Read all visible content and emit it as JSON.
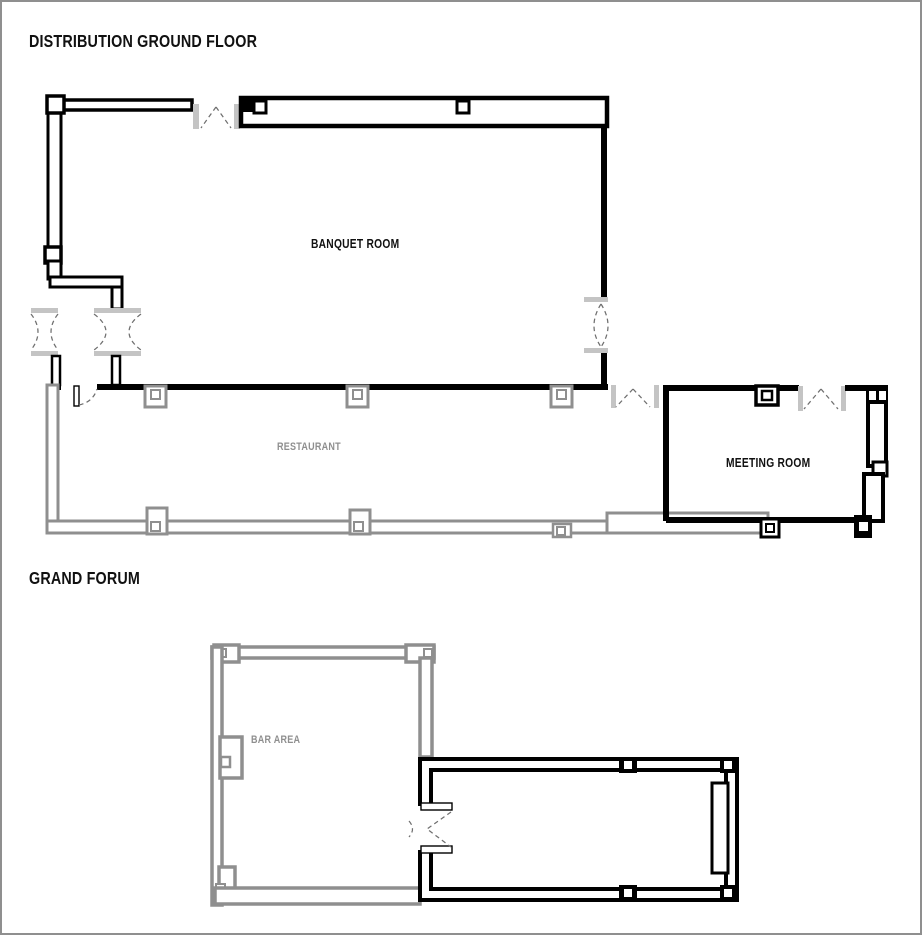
{
  "page": {
    "width": 922,
    "height": 935,
    "background": "#ffffff"
  },
  "colors": {
    "wall_primary": "#000000",
    "wall_secondary": "#8f8f8f",
    "door_jamb": "#c4c4c4",
    "door_swing_dash": "#6f6f6f",
    "label_primary": "#111111",
    "label_muted": "#8f8f8f",
    "page_border": "#8f8f8f"
  },
  "plans": [
    {
      "id": "distribution-ground-floor",
      "title": "DISTRIBUTION GROUND FLOOR",
      "rooms": [
        {
          "name": "BANQUET ROOM",
          "tone": "primary"
        },
        {
          "name": "RESTAURANT",
          "tone": "muted"
        },
        {
          "name": "MEETING ROOM",
          "tone": "primary"
        }
      ]
    },
    {
      "id": "grand-forum",
      "title": "GRAND FORUM",
      "rooms": [
        {
          "name": "BAR AREA",
          "tone": "muted"
        }
      ]
    }
  ]
}
